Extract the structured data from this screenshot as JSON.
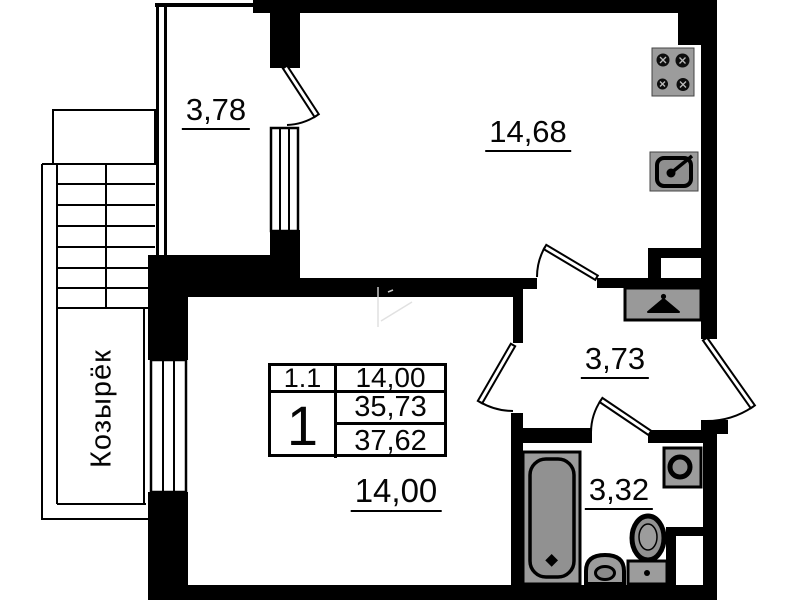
{
  "rooms": {
    "balcony": {
      "name": "balcony",
      "area": "3,78"
    },
    "kitchen": {
      "name": "kitchen",
      "area": "14,68"
    },
    "living": {
      "name": "living-room",
      "area": "14,00"
    },
    "hallway": {
      "name": "hallway",
      "area": "3,73"
    },
    "bathroom": {
      "name": "bathroom",
      "area": "3,32"
    }
  },
  "canopy": {
    "label": "Козырёк"
  },
  "info_table": {
    "unit_number": "1.1",
    "unit_area": "14,00",
    "rooms_count": "1",
    "living_area_total": "35,73",
    "overall_area_total": "37,62"
  },
  "fixtures": [
    "stove-icon",
    "kitchen-sink-icon",
    "hanger-wardrobe-icon",
    "washing-machine-icon",
    "bathtub-icon",
    "toilet-icon",
    "wash-basin-icon"
  ],
  "colors": {
    "line": "#000000",
    "fixture_fill": "#9c9c9c",
    "fixture_inner": "#8f8f8f",
    "background": "#ffffff"
  }
}
